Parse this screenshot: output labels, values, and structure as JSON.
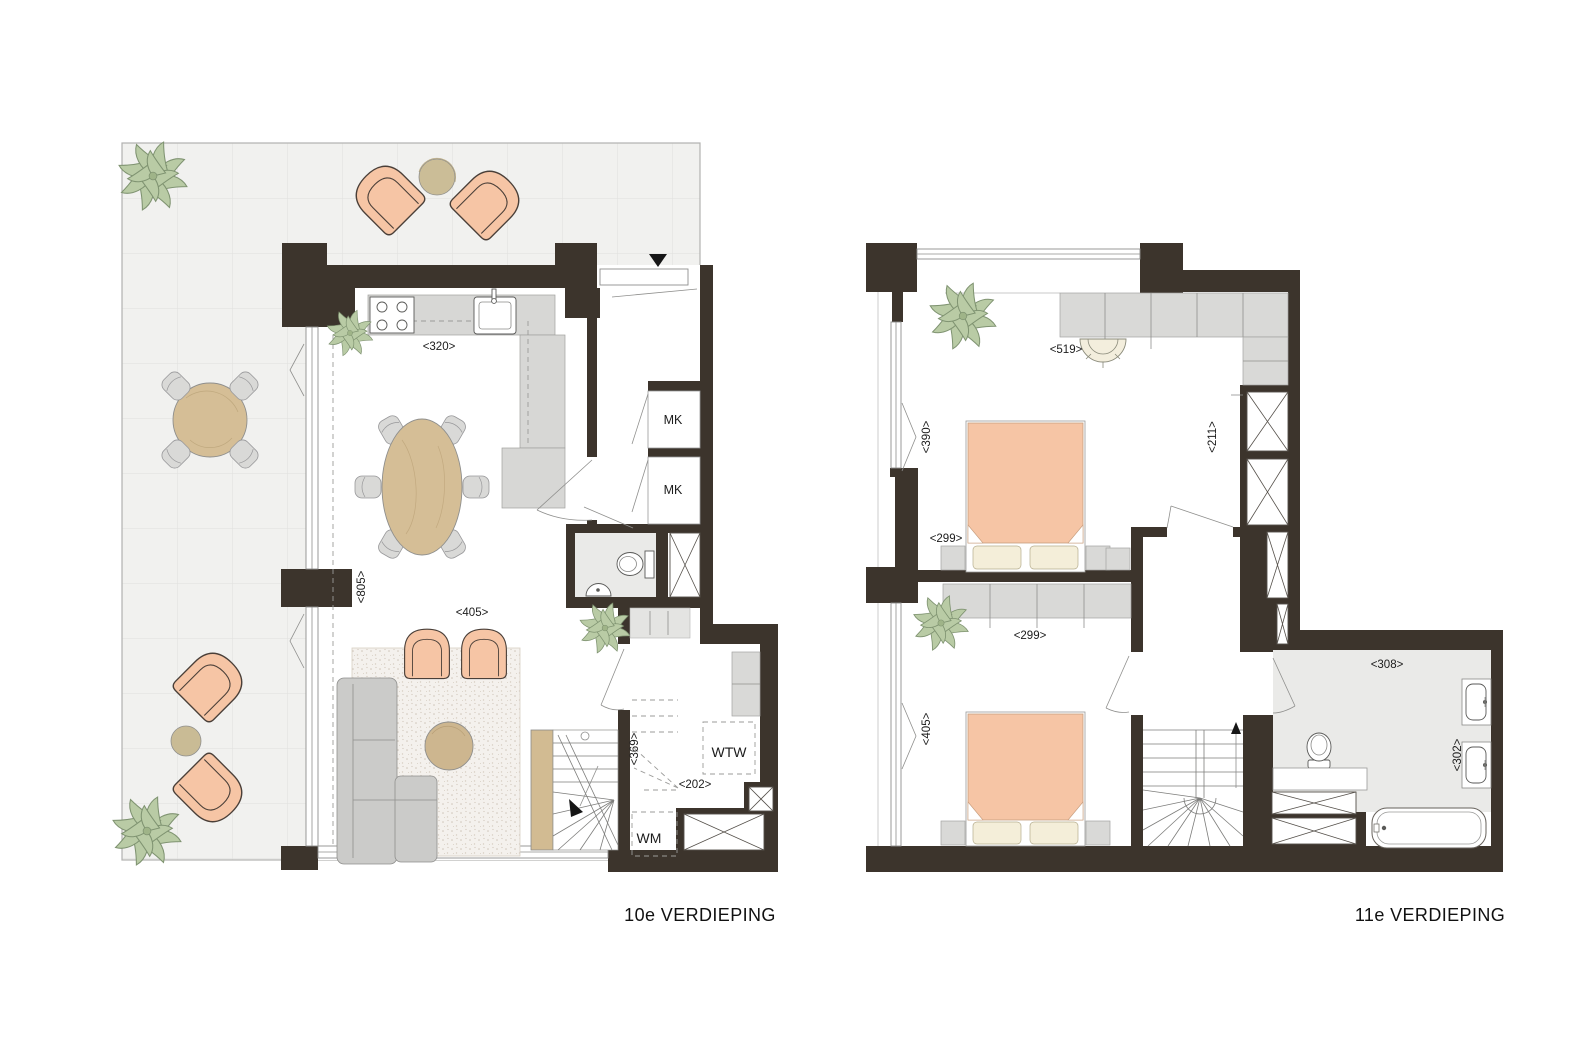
{
  "diagram": {
    "type": "architectural-floorplan",
    "floors": [
      {
        "title": "10e VERDIEPING",
        "labels": {
          "kitchen_width": "<320>",
          "living_depth": "<805>",
          "living_width": "<405>",
          "stair_width": "<369>",
          "tech_width": "<202>",
          "meter_closet_1": "MK",
          "meter_closet_2": "MK",
          "heat_recovery": "WTW",
          "washing_machine": "WM"
        }
      },
      {
        "title": "11e VERDIEPING",
        "labels": {
          "bedroom1_width": "<519>",
          "bedroom1_window": "<390>",
          "shaft_width": "<211>",
          "bed1_width": "<299>",
          "bed2_width": "<299>",
          "bedroom2_window": "<405>",
          "bathroom_width": "<308>",
          "bathroom_depth": "<302>"
        }
      }
    ],
    "colors": {
      "wall": "#3c342c",
      "floor": "#ffffff",
      "terrace_tile": "#f1f1ef",
      "terrace_grid": "#e2e2e0",
      "wet_room_floor": "#eaeae8",
      "cabinet_gray": "#d9d9d7",
      "counter_gray": "#d7d7d5",
      "accent_peach": "#f6c5a5",
      "wood": "#d5be96",
      "plant_green": "#b9cba5",
      "pillow_cream": "#f4eed9",
      "line_dark": "#1c1c1c"
    }
  }
}
